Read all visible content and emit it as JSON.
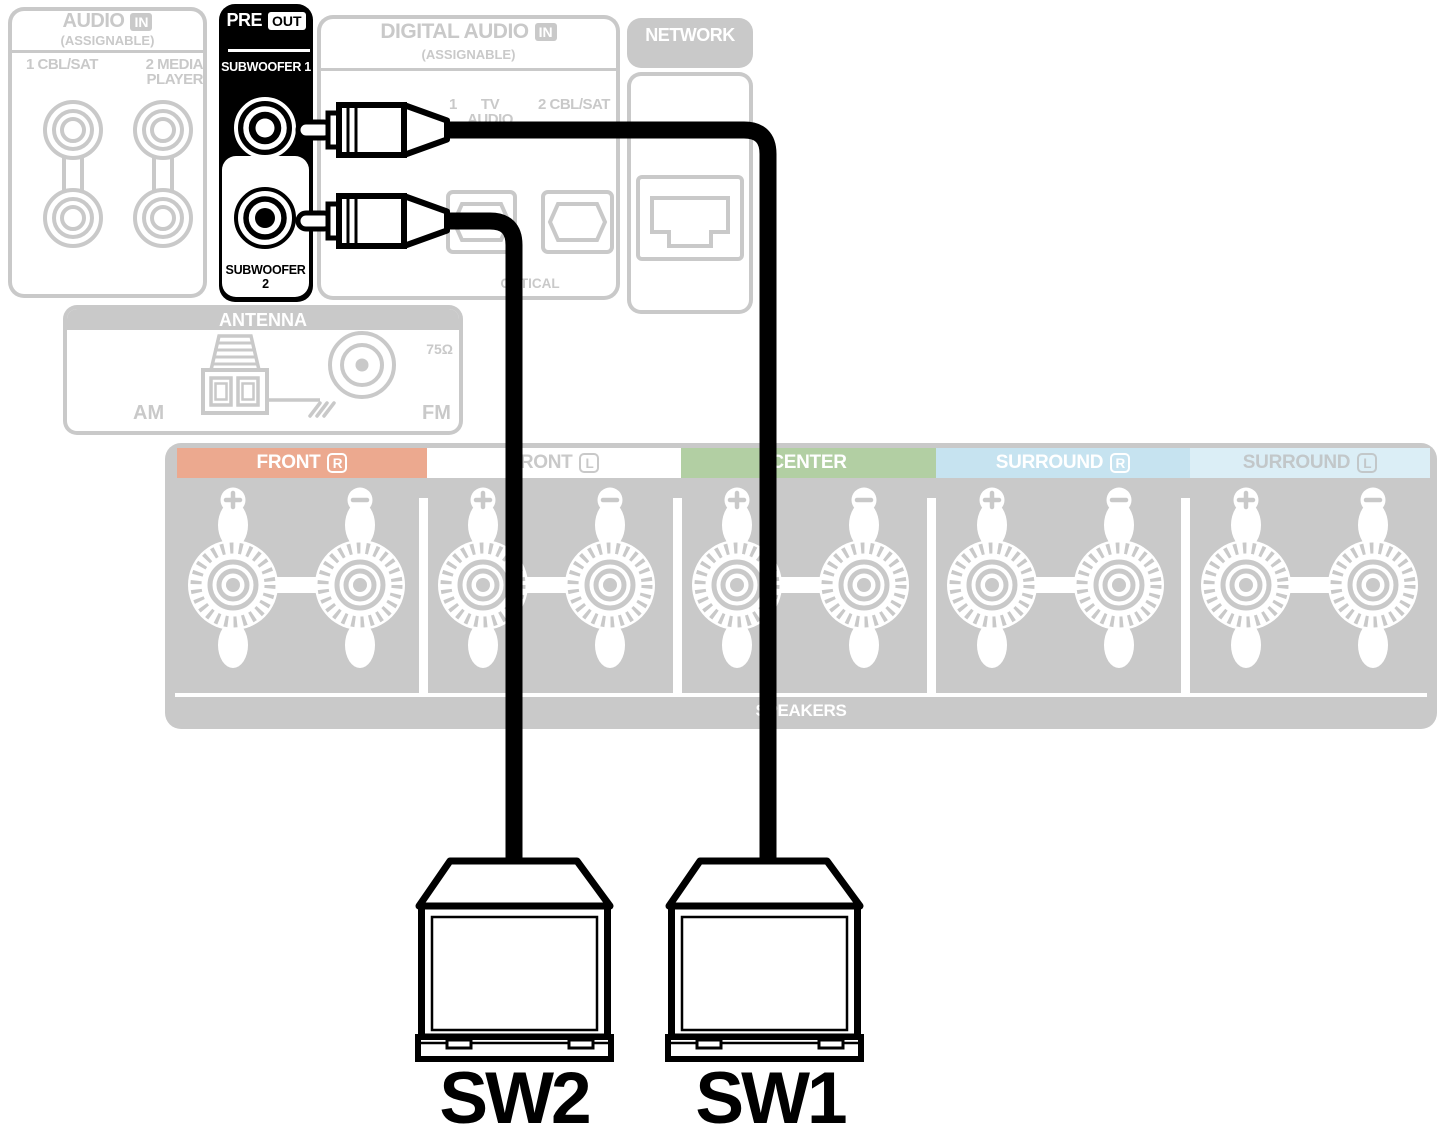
{
  "receiver": {
    "audio_in": {
      "title": "AUDIO",
      "in_badge": "IN",
      "subtitle": "(ASSIGNABLE)",
      "label_left": "1 CBL/SAT",
      "label_right_line1": "2 MEDIA",
      "label_right_line2": "PLAYER"
    },
    "pre_out": {
      "title": "PRE",
      "out_badge": "OUT",
      "subwoofer1_label": "SUBWOOFER 1",
      "subwoofer2_label": "SUBWOOFER 2"
    },
    "digital_audio_in": {
      "title": "DIGITAL AUDIO",
      "in_badge": "IN",
      "subtitle": "(ASSIGNABLE)",
      "port1_number": "1",
      "port1_name_line1": "TV",
      "port1_name_line2": "AUDIO",
      "port2_label": "2 CBL/SAT",
      "connector_type": "OPTICAL"
    },
    "network": {
      "title": "NETWORK"
    },
    "antenna": {
      "title": "ANTENNA",
      "am_label": "AM",
      "fm_label": "FM",
      "fm_impedance": "75Ω"
    },
    "speaker_terminals": {
      "footer_label": "SPEAKERS",
      "sections": [
        {
          "label": "FRONT",
          "channel": "R",
          "band_color": "#eca98f",
          "label_color": "#ffffff"
        },
        {
          "label": "FRONT",
          "channel": "L",
          "band_color": "#ffffff",
          "label_color": "#c9c9c9"
        },
        {
          "label": "CENTER",
          "channel": "",
          "band_color": "#b2cfa3",
          "label_color": "#ffffff"
        },
        {
          "label": "SURROUND",
          "channel": "R",
          "band_color": "#c6e3f0",
          "label_color": "#ffffff"
        },
        {
          "label": "SURROUND",
          "channel": "L",
          "band_color": "#dbeef6",
          "label_color": "#c2c7c9"
        }
      ]
    }
  },
  "subwoofers": {
    "sw2_label": "SW2",
    "sw1_label": "SW1"
  },
  "colors": {
    "faded_gray": "#c9c9c9",
    "highlight_black": "#000000",
    "cable_black": "#000000"
  }
}
